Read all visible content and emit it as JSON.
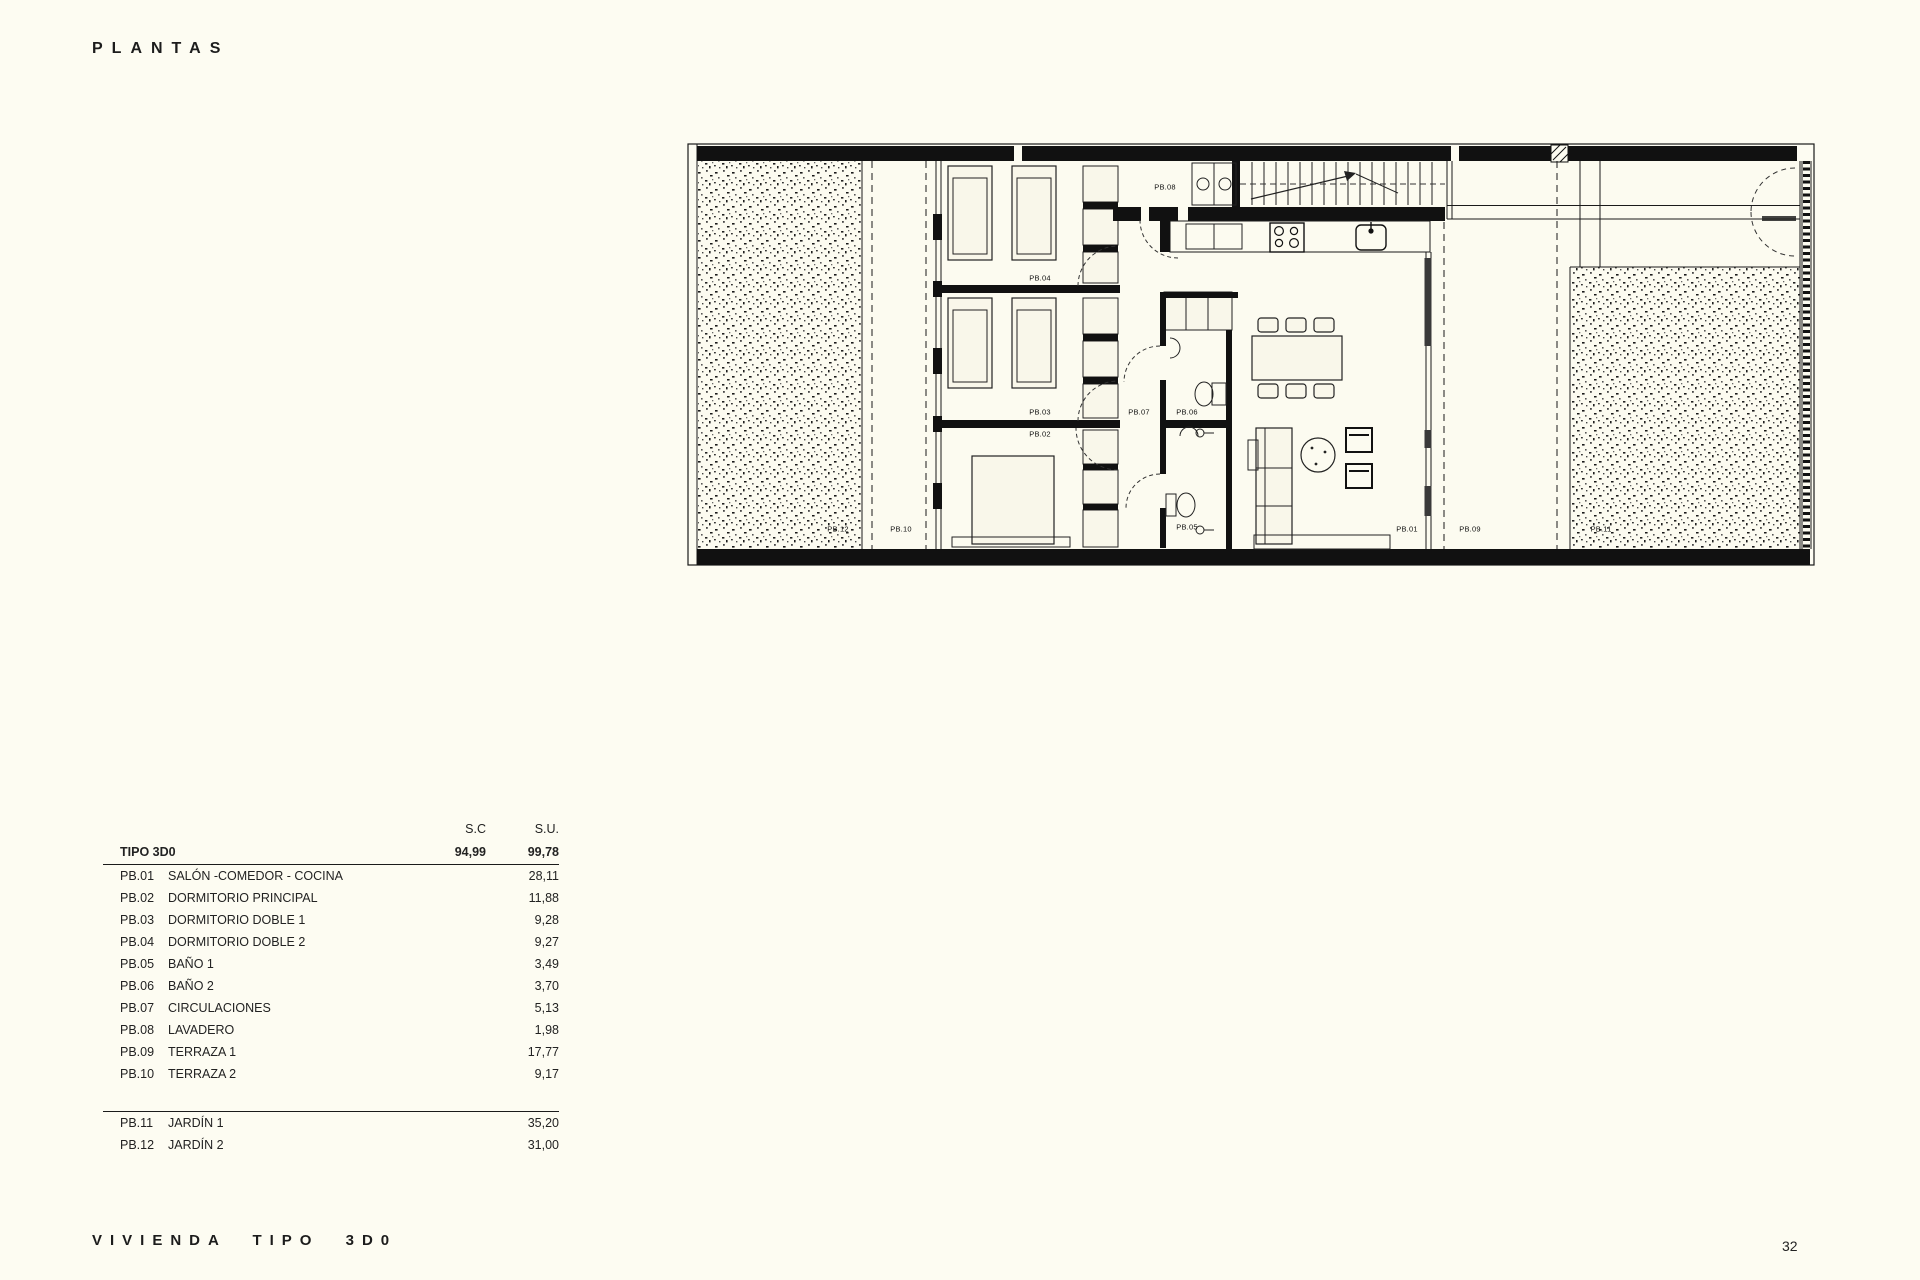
{
  "page": {
    "title": "PLANTAS",
    "footer": "VIVIENDA TIPO 3D0",
    "page_number": "32"
  },
  "area_table": {
    "col_headers": [
      "S.C",
      "S.U."
    ],
    "total_row": {
      "label": "TIPO 3D0",
      "sc": "94,99",
      "su": "99,78"
    },
    "rows": [
      {
        "code": "PB.01",
        "name": "SALÓN -COMEDOR - COCINA",
        "su": "28,11"
      },
      {
        "code": "PB.02",
        "name": "DORMITORIO PRINCIPAL",
        "su": "11,88"
      },
      {
        "code": "PB.03",
        "name": "DORMITORIO DOBLE 1",
        "su": "9,28"
      },
      {
        "code": "PB.04",
        "name": "DORMITORIO DOBLE 2",
        "su": "9,27"
      },
      {
        "code": "PB.05",
        "name": "BAÑO 1",
        "su": "3,49"
      },
      {
        "code": "PB.06",
        "name": "BAÑO 2",
        "su": "3,70"
      },
      {
        "code": "PB.07",
        "name": "CIRCULACIONES",
        "su": "5,13"
      },
      {
        "code": "PB.08",
        "name": "LAVADERO",
        "su": "1,98"
      },
      {
        "code": "PB.09",
        "name": "TERRAZA 1",
        "su": "17,77"
      },
      {
        "code": "PB.10",
        "name": "TERRAZA 2",
        "su": "9,17"
      }
    ],
    "rows_exterior": [
      {
        "code": "PB.11",
        "name": "JARDÍN 1",
        "su": "35,20"
      },
      {
        "code": "PB.12",
        "name": "JARDÍN 2",
        "su": "31,00"
      }
    ]
  },
  "plan": {
    "labels": [
      {
        "text": "PB.08",
        "x": 1165,
        "y": 187
      },
      {
        "text": "PB.04",
        "x": 1040,
        "y": 278
      },
      {
        "text": "PB.03",
        "x": 1040,
        "y": 412
      },
      {
        "text": "PB.02",
        "x": 1040,
        "y": 434
      },
      {
        "text": "PB.07",
        "x": 1139,
        "y": 412
      },
      {
        "text": "PB.06",
        "x": 1187,
        "y": 412
      },
      {
        "text": "PB.05",
        "x": 1187,
        "y": 527
      },
      {
        "text": "PB.12",
        "x": 838,
        "y": 529
      },
      {
        "text": "PB.10",
        "x": 901,
        "y": 529
      },
      {
        "text": "PB.01",
        "x": 1407,
        "y": 529
      },
      {
        "text": "PB.09",
        "x": 1470,
        "y": 529
      },
      {
        "text": "PB.11",
        "x": 1601,
        "y": 529
      }
    ]
  }
}
